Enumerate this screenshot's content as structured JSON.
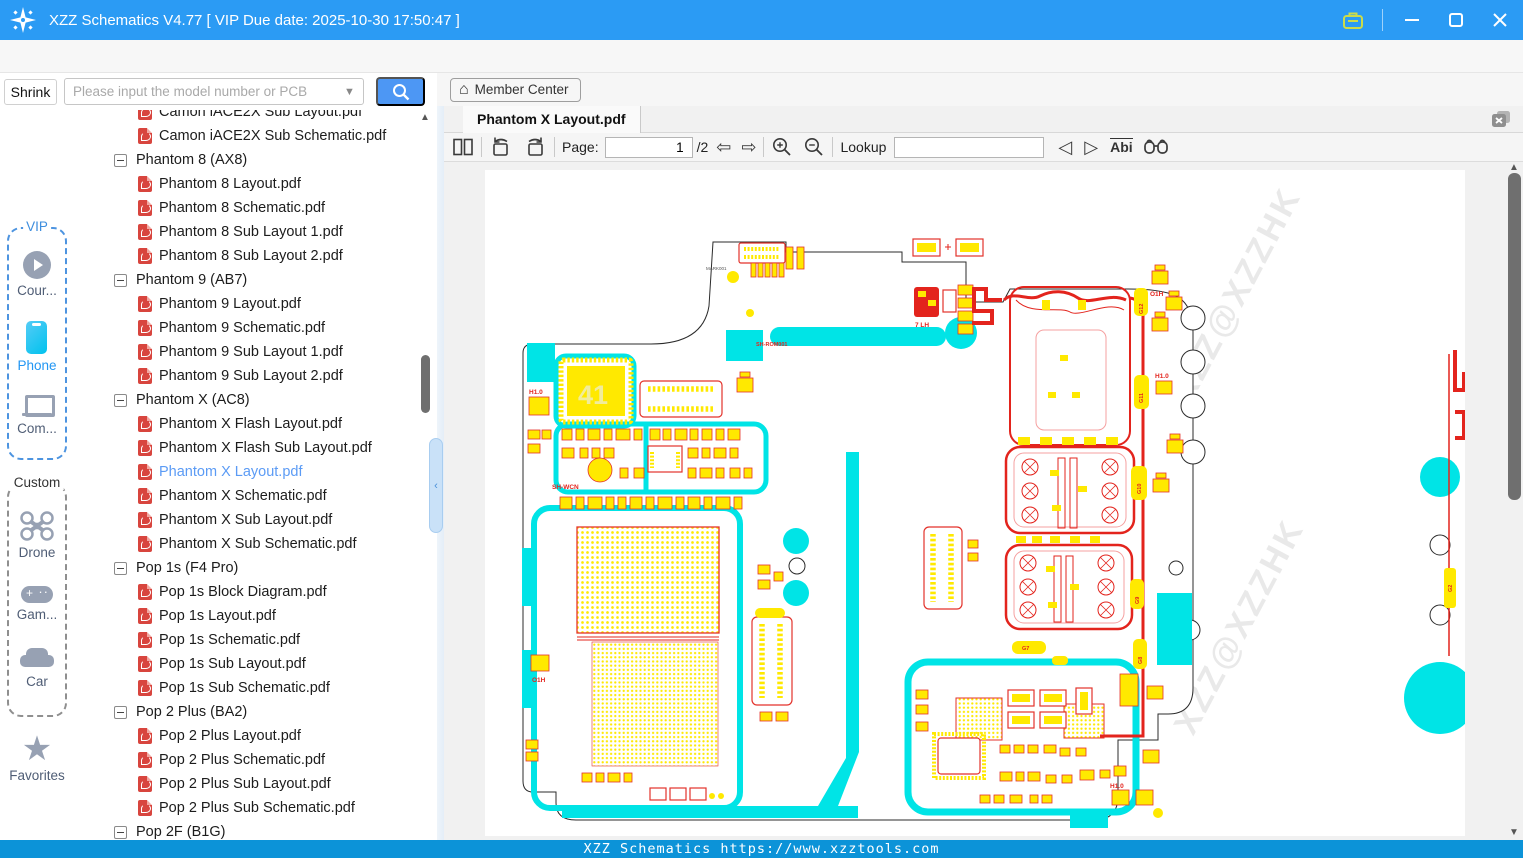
{
  "window": {
    "title": "XZZ Schematics V4.77 [ VIP Due date: 2025-10-30 17:50:47 ]"
  },
  "menu": {
    "items": [
      "File(F)",
      "VIP(V)",
      "Tool(T)",
      "Settings(S)"
    ]
  },
  "search": {
    "shrink_label": "Shrink",
    "placeholder": "Please input the model number or PCB"
  },
  "member_center": {
    "label": "Member Center"
  },
  "sidebar": {
    "vip_label": "VIP",
    "vip_items": {
      "course": {
        "label": "Cour..."
      },
      "phone": {
        "label": "Phone"
      },
      "computer": {
        "label": "Com..."
      }
    },
    "custom_label": "Custom",
    "custom_items": {
      "drone": {
        "label": "Drone"
      },
      "game": {
        "label": "Gam..."
      },
      "car": {
        "label": "Car"
      }
    },
    "favorites_label": "Favorites"
  },
  "tree": {
    "items": [
      {
        "type": "file",
        "label": "Camon iACE2X Sub Layout.pdf"
      },
      {
        "type": "file",
        "label": "Camon iACE2X Sub Schematic.pdf"
      },
      {
        "type": "group",
        "label": "Phantom 8 (AX8)"
      },
      {
        "type": "file",
        "label": "Phantom 8 Layout.pdf"
      },
      {
        "type": "file",
        "label": "Phantom 8 Schematic.pdf"
      },
      {
        "type": "file",
        "label": "Phantom 8 Sub Layout 1.pdf"
      },
      {
        "type": "file",
        "label": "Phantom 8 Sub Layout 2.pdf"
      },
      {
        "type": "group",
        "label": "Phantom 9 (AB7)"
      },
      {
        "type": "file",
        "label": "Phantom 9 Layout.pdf"
      },
      {
        "type": "file",
        "label": "Phantom 9 Schematic.pdf"
      },
      {
        "type": "file",
        "label": "Phantom 9 Sub Layout 1.pdf"
      },
      {
        "type": "file",
        "label": "Phantom 9 Sub Layout 2.pdf"
      },
      {
        "type": "group",
        "label": "Phantom X (AC8)"
      },
      {
        "type": "file",
        "label": "Phantom X Flash Layout.pdf"
      },
      {
        "type": "file",
        "label": "Phantom X Flash Sub Layout.pdf"
      },
      {
        "type": "file",
        "label": "Phantom X Layout.pdf",
        "selected": true
      },
      {
        "type": "file",
        "label": "Phantom X Schematic.pdf"
      },
      {
        "type": "file",
        "label": "Phantom X Sub Layout.pdf"
      },
      {
        "type": "file",
        "label": "Phantom X Sub Schematic.pdf"
      },
      {
        "type": "group",
        "label": "Pop 1s (F4 Pro)"
      },
      {
        "type": "file",
        "label": "Pop 1s Block Diagram.pdf"
      },
      {
        "type": "file",
        "label": "Pop 1s Layout.pdf"
      },
      {
        "type": "file",
        "label": "Pop 1s Schematic.pdf"
      },
      {
        "type": "file",
        "label": "Pop 1s Sub Layout.pdf"
      },
      {
        "type": "file",
        "label": "Pop 1s Sub Schematic.pdf"
      },
      {
        "type": "group",
        "label": "Pop 2 Plus (BA2)"
      },
      {
        "type": "file",
        "label": "Pop 2 Plus Layout.pdf"
      },
      {
        "type": "file",
        "label": "Pop 2 Plus Schematic.pdf"
      },
      {
        "type": "file",
        "label": "Pop 2 Plus Sub Layout.pdf"
      },
      {
        "type": "file",
        "label": "Pop 2 Plus Sub Schematic.pdf"
      },
      {
        "type": "group",
        "label": "Pop 2F (B1G)"
      }
    ]
  },
  "viewer": {
    "tab": "Phantom X Layout.pdf",
    "toolbar": {
      "page_label": "Page:",
      "page_value": "1",
      "page_total": "/2",
      "lookup_label": "Lookup",
      "lookup_value": "",
      "abi_label": "Abi"
    }
  },
  "statusbar": {
    "text": "XZZ Schematics https://www.xzztools.com"
  },
  "pcb": {
    "watermark": "XZZ@XZZHK",
    "chip_label": "41",
    "labels": {
      "seven_lh": "7 LH",
      "sh_rom": "SH-ROM001",
      "sh_wcn": "SH-WCN",
      "mark1": "MARK001",
      "o1h": "O1H",
      "h10": "H1.0"
    },
    "pads": {
      "g12": "G12",
      "g11": "G11",
      "g10": "G10",
      "g9": "G9",
      "g8": "G8",
      "g7": "G7",
      "g2": "G2"
    }
  }
}
